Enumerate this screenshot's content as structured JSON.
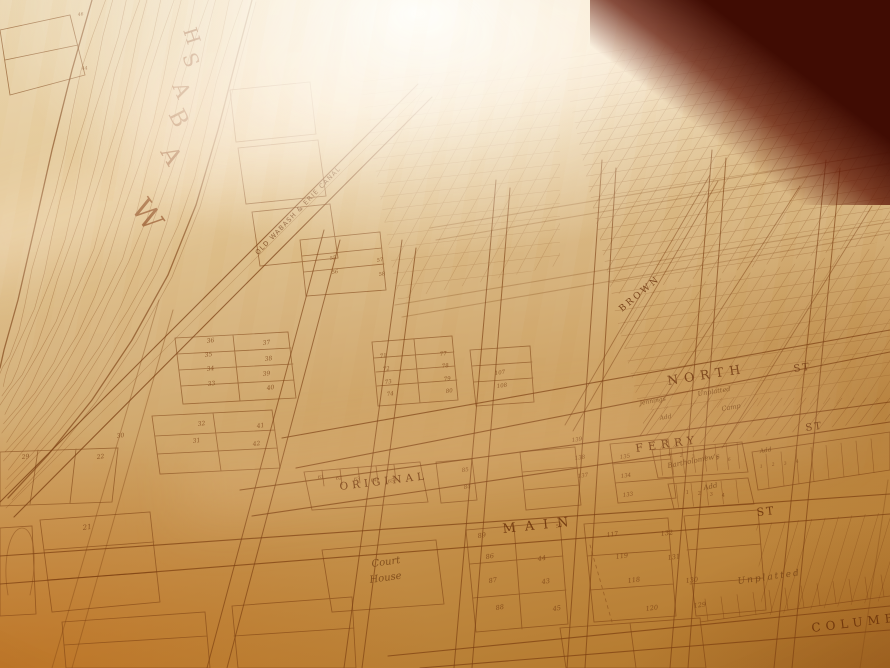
{
  "colors": {
    "ink": "#7c3f12",
    "paper_light": "#f3e7cf",
    "paper_mid": "#d6b27b",
    "paper_amber": "#b87a2c",
    "table_edge_dark": "#400c03",
    "glare_white": "#fffdf8"
  },
  "map": {
    "river_name": "WABASH",
    "river_letters": [
      {
        "t": "W",
        "x": 130,
        "y": 208,
        "r": 55,
        "s": 30
      },
      {
        "t": "A",
        "x": 160,
        "y": 152,
        "r": 60,
        "s": 24
      },
      {
        "t": "B",
        "x": 168,
        "y": 114,
        "r": 63,
        "s": 23
      },
      {
        "t": "A",
        "x": 172,
        "y": 86,
        "r": 66,
        "s": 21
      },
      {
        "t": "S",
        "x": 182,
        "y": 56,
        "r": 69,
        "s": 20
      },
      {
        "t": "H",
        "x": 183,
        "y": 30,
        "r": 72,
        "s": 19
      }
    ],
    "canal_label": {
      "t": "OLD WABASH & ERIE CANAL",
      "x": 258,
      "y": 255,
      "r": -46,
      "s": 6.5,
      "sp": 1.2
    },
    "street_labels": [
      {
        "t": "NORTH",
        "x": 668,
        "y": 385,
        "r": -9,
        "s": 12.5,
        "sp": 6
      },
      {
        "t": "ST",
        "x": 794,
        "y": 372,
        "r": -8,
        "s": 10,
        "sp": 2
      },
      {
        "t": "FERRY",
        "x": 636,
        "y": 452,
        "r": -8,
        "s": 11,
        "sp": 5
      },
      {
        "t": "ST",
        "x": 806,
        "y": 431,
        "r": -8,
        "s": 10,
        "sp": 2
      },
      {
        "t": "MAIN",
        "x": 503,
        "y": 533,
        "r": -6,
        "s": 13,
        "sp": 9
      },
      {
        "t": "ST",
        "x": 757,
        "y": 516,
        "r": -6,
        "s": 11,
        "sp": 2
      },
      {
        "t": "COLUMBIA",
        "x": 812,
        "y": 632,
        "r": -7,
        "s": 12,
        "sp": 5
      },
      {
        "t": "BROWN",
        "x": 622,
        "y": 312,
        "r": -40,
        "s": 9,
        "sp": 2.5
      }
    ],
    "area_labels": [
      {
        "t": "ORIGINAL",
        "x": 340,
        "y": 490,
        "r": -7,
        "s": 10.5,
        "sp": 4,
        "cls": "street"
      },
      {
        "t": "Court",
        "x": 372,
        "y": 567,
        "r": -8,
        "s": 10,
        "cls": "script"
      },
      {
        "t": "House",
        "x": 370,
        "y": 583,
        "r": -8,
        "s": 10,
        "cls": "script"
      },
      {
        "t": "Bartholomew's",
        "x": 668,
        "y": 468,
        "r": -11,
        "s": 7,
        "cls": "script"
      },
      {
        "t": "Add",
        "x": 704,
        "y": 490,
        "r": -11,
        "s": 7,
        "cls": "script"
      },
      {
        "t": "Jennings",
        "x": 640,
        "y": 405,
        "r": -10,
        "s": 6,
        "cls": "script"
      },
      {
        "t": "Add",
        "x": 660,
        "y": 420,
        "r": -10,
        "s": 6,
        "cls": "script"
      },
      {
        "t": "Camp",
        "x": 722,
        "y": 411,
        "r": -10,
        "s": 6.5,
        "cls": "script"
      },
      {
        "t": "Unplatted",
        "x": 698,
        "y": 396,
        "r": -9,
        "s": 6.5,
        "cls": "script"
      },
      {
        "t": "Unplatted",
        "x": 738,
        "y": 584,
        "r": -8,
        "s": 9,
        "sp": 2,
        "cls": "script"
      },
      {
        "t": "Add",
        "x": 760,
        "y": 453,
        "r": -9,
        "s": 6,
        "cls": "script"
      }
    ],
    "lot_numbers": [
      [
        46,
        78,
        16,
        4.5
      ],
      [
        44,
        82,
        70,
        4.5
      ],
      [
        36,
        207,
        343,
        6
      ],
      [
        35,
        205,
        357,
        6
      ],
      [
        34,
        207,
        371,
        6
      ],
      [
        33,
        208,
        386,
        6
      ],
      [
        37,
        263,
        345,
        6
      ],
      [
        38,
        265,
        361,
        6
      ],
      [
        39,
        263,
        376,
        6
      ],
      [
        40,
        267,
        390,
        6
      ],
      [
        32,
        198,
        426,
        6
      ],
      [
        31,
        193,
        443,
        6
      ],
      [
        41,
        257,
        428,
        6
      ],
      [
        42,
        253,
        446,
        6
      ],
      [
        30,
        117,
        438,
        6
      ],
      [
        29,
        22,
        459,
        6
      ],
      [
        22,
        97,
        459,
        6
      ],
      [
        21,
        83,
        530,
        7
      ],
      [
        55,
        330,
        260,
        5
      ],
      [
        56,
        332,
        274,
        5
      ],
      [
        57,
        377,
        262,
        5
      ],
      [
        58,
        379,
        276,
        5
      ],
      [
        71,
        380,
        358,
        5.5
      ],
      [
        72,
        383,
        371,
        5.5
      ],
      [
        73,
        385,
        384,
        5.5
      ],
      [
        74,
        387,
        396,
        5.5
      ],
      [
        77,
        440,
        356,
        5.5
      ],
      [
        78,
        442,
        368,
        5.5
      ],
      [
        79,
        444,
        381,
        5.5
      ],
      [
        80,
        446,
        393,
        5.5
      ],
      [
        107,
        495,
        375,
        5.5
      ],
      [
        108,
        497,
        388,
        5.5
      ],
      [
        61,
        318,
        479,
        5
      ],
      [
        62,
        336,
        480,
        5
      ],
      [
        63,
        354,
        481,
        5
      ],
      [
        64,
        371,
        482,
        5
      ],
      [
        65,
        388,
        483,
        5
      ],
      [
        85,
        462,
        472,
        5.5
      ],
      [
        84,
        464,
        489,
        5.5
      ],
      [
        89,
        478,
        538,
        6.5
      ],
      [
        50,
        556,
        528,
        5
      ],
      [
        117,
        607,
        537,
        6
      ],
      [
        132,
        661,
        536,
        6.5
      ],
      [
        86,
        486,
        559,
        6.5
      ],
      [
        87,
        489,
        583,
        6.5
      ],
      [
        88,
        496,
        610,
        6.5
      ],
      [
        44,
        538,
        561,
        6.5
      ],
      [
        43,
        542,
        584,
        6.5
      ],
      [
        45,
        553,
        611,
        6.5
      ],
      [
        119,
        616,
        559,
        6.5
      ],
      [
        118,
        628,
        583,
        6.5
      ],
      [
        120,
        646,
        611,
        6.5
      ],
      [
        131,
        668,
        560,
        6.5
      ],
      [
        130,
        686,
        583,
        6.5
      ],
      [
        129,
        694,
        608,
        6.5
      ],
      [
        139,
        572,
        442,
        5.5
      ],
      [
        138,
        575,
        460,
        5.5
      ],
      [
        137,
        578,
        478,
        5.5
      ],
      [
        135,
        620,
        459,
        5.5
      ],
      [
        134,
        621,
        478,
        5.5
      ],
      [
        133,
        623,
        497,
        5.5
      ],
      [
        1,
        668,
        456,
        4.5
      ],
      [
        2,
        680,
        457,
        4.5
      ],
      [
        3,
        692,
        458,
        4.5
      ],
      [
        4,
        704,
        459,
        4.5
      ],
      [
        5,
        716,
        460,
        4.5
      ],
      [
        6,
        728,
        461,
        4.5
      ],
      [
        1,
        686,
        494,
        5
      ],
      [
        2,
        698,
        495,
        5
      ],
      [
        3,
        710,
        496,
        5
      ],
      [
        4,
        722,
        497,
        5
      ],
      [
        1,
        760,
        468,
        4.5
      ],
      [
        2,
        772,
        466,
        4.5
      ],
      [
        3,
        784,
        465,
        4.5
      ],
      [
        4,
        796,
        463,
        4.5
      ]
    ]
  }
}
